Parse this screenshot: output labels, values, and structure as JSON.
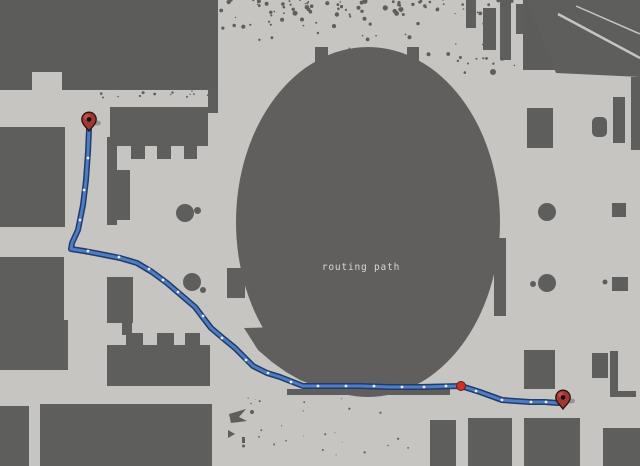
{
  "map": {
    "label": "routing path",
    "colors": {
      "background": "#5c5c5a",
      "free_space": "#c7c5c1",
      "obstacle": "#5e5e5c",
      "oval": "#605f5d",
      "path_outer": "#1f3c6d",
      "path_inner": "#4f7dc1",
      "waypoint_dot": "#f2f4f6",
      "via_dot": "#cc3227",
      "via_dot_edge": "#701911",
      "pin_fill": "#9e3831",
      "pin_outline": "#2b100c",
      "pin_center": "#170a08",
      "label_text": "#d8d8d4"
    },
    "route": {
      "points": [
        [
          89,
          129
        ],
        [
          88,
          152
        ],
        [
          86,
          180
        ],
        [
          83,
          205
        ],
        [
          78,
          230
        ],
        [
          72,
          243
        ],
        [
          71,
          249
        ],
        [
          84,
          251
        ],
        [
          100,
          254
        ],
        [
          120,
          258
        ],
        [
          137,
          263
        ],
        [
          152,
          272
        ],
        [
          167,
          283
        ],
        [
          181,
          295
        ],
        [
          195,
          307
        ],
        [
          211,
          328
        ],
        [
          224,
          339
        ],
        [
          235,
          348
        ],
        [
          253,
          366
        ],
        [
          267,
          373
        ],
        [
          280,
          377
        ],
        [
          303,
          386
        ],
        [
          330,
          386
        ],
        [
          360,
          386
        ],
        [
          390,
          387
        ],
        [
          420,
          387
        ],
        [
          461,
          386
        ],
        [
          480,
          392
        ],
        [
          502,
          400
        ],
        [
          515,
          401
        ],
        [
          530,
          402
        ],
        [
          545,
          402
        ],
        [
          558,
          403
        ]
      ],
      "waypoints": [
        [
          88,
          158
        ],
        [
          84,
          190
        ],
        [
          80,
          220
        ],
        [
          88,
          251
        ],
        [
          119,
          257
        ],
        [
          149,
          269
        ],
        [
          163,
          280
        ],
        [
          178,
          292
        ],
        [
          203,
          316
        ],
        [
          222,
          338
        ],
        [
          246,
          360
        ],
        [
          268,
          373
        ],
        [
          291,
          382
        ],
        [
          318,
          386
        ],
        [
          346,
          386
        ],
        [
          374,
          386
        ],
        [
          402,
          387
        ],
        [
          424,
          387
        ],
        [
          446,
          386
        ],
        [
          476,
          391
        ],
        [
          502,
          400
        ],
        [
          531,
          402
        ],
        [
          546,
          402
        ]
      ],
      "start_pin": {
        "x": 89,
        "y": 131
      },
      "end_pin": {
        "x": 563,
        "y": 409
      },
      "via_dot": {
        "x": 461,
        "y": 386
      }
    }
  }
}
